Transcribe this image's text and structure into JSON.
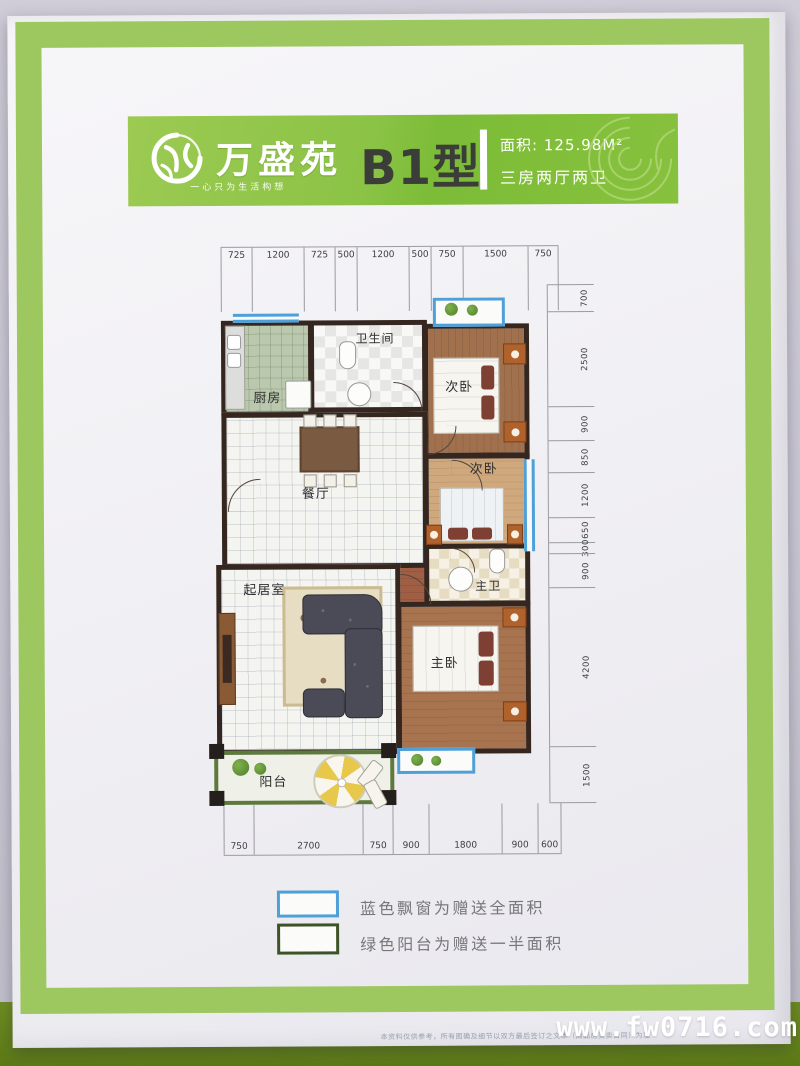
{
  "header": {
    "project_name": "万盛苑",
    "tagline": "一心只为生活构想",
    "unit_type": "B1型",
    "area_label": "面积:",
    "area_value": "125.98M²",
    "layout_spec": "三房两厅两卫"
  },
  "plan": {
    "dims_top": [
      "725",
      "1200",
      "725",
      "500",
      "1200",
      "500",
      "750",
      "1500",
      "750"
    ],
    "dims_right": [
      "700",
      "2500",
      "900",
      "850",
      "1200",
      "650",
      "300",
      "900",
      "4200",
      "1500"
    ],
    "dims_bottom": [
      "750",
      "2700",
      "750",
      "900",
      "1800",
      "900",
      "600"
    ],
    "rooms": {
      "kitchen": "厨房",
      "bathroom": "卫生间",
      "bedroom_top": "次卧",
      "bedroom_mid": "次卧",
      "dining": "餐厅",
      "master_bath": "主卫",
      "living": "起居室",
      "master_bedroom": "主卧",
      "balcony": "阳台"
    }
  },
  "legend": {
    "items": [
      {
        "swatch_color": "#4ea0d8",
        "text": "蓝色飘窗为赠送全面积"
      },
      {
        "swatch_color": "#3d5226",
        "text": "绿色阳台为赠送一半面积"
      }
    ]
  },
  "footer": {
    "disclaimer": "本资料仅供参考，所有图确及细节以双方最后签订之文本（商品房买卖合同）为准",
    "watermark": "www.fw0716.com"
  },
  "colors": {
    "page_border_green": "#9dc75f",
    "banner_green": "#8bc346",
    "wall_dark": "#352720",
    "window_blue": "#4ea0d8",
    "balcony_green": "#5d7a3c",
    "photo_band_green": "#5b7a16"
  }
}
